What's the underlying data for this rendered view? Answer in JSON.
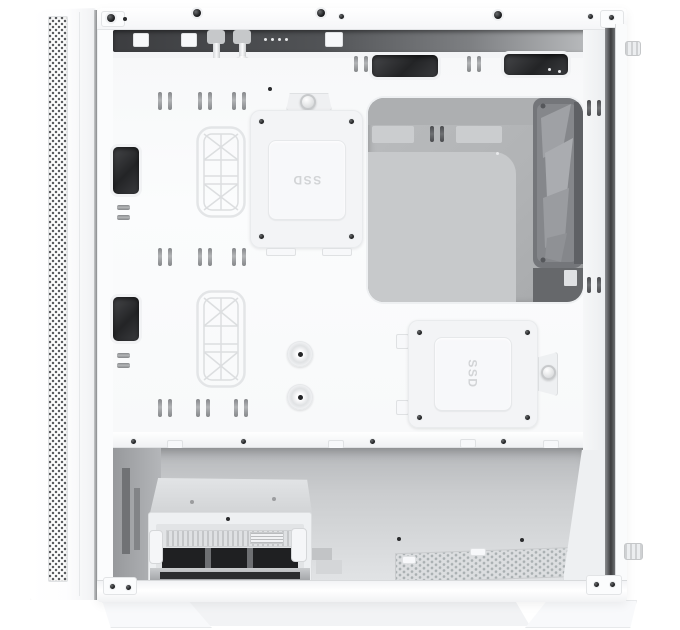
{
  "scene": {
    "type": "product-photo",
    "subject": "White mid-tower PC case with side panel removed, interior cable-management view",
    "background": "#ffffff"
  },
  "labels": {
    "ssd_bracket_top": "SSD",
    "ssd_bracket_bottom": "SSD"
  },
  "colors": {
    "case_white": "#fbfcfd",
    "tray_white": "#f8f9fa",
    "cutout_dark": "#2e2f32",
    "channel_dark": "#3c3d40",
    "glass_gray": "#b3b5b7",
    "glass_reflection": "#c7c9cb",
    "fan_frame_gray": "#74767a",
    "fan_blade_gray": "#a4a6aa",
    "emboss_line": "#dcdee0",
    "mesh_gray": "#aab0b2",
    "screw_black": "#1b1c1e"
  }
}
